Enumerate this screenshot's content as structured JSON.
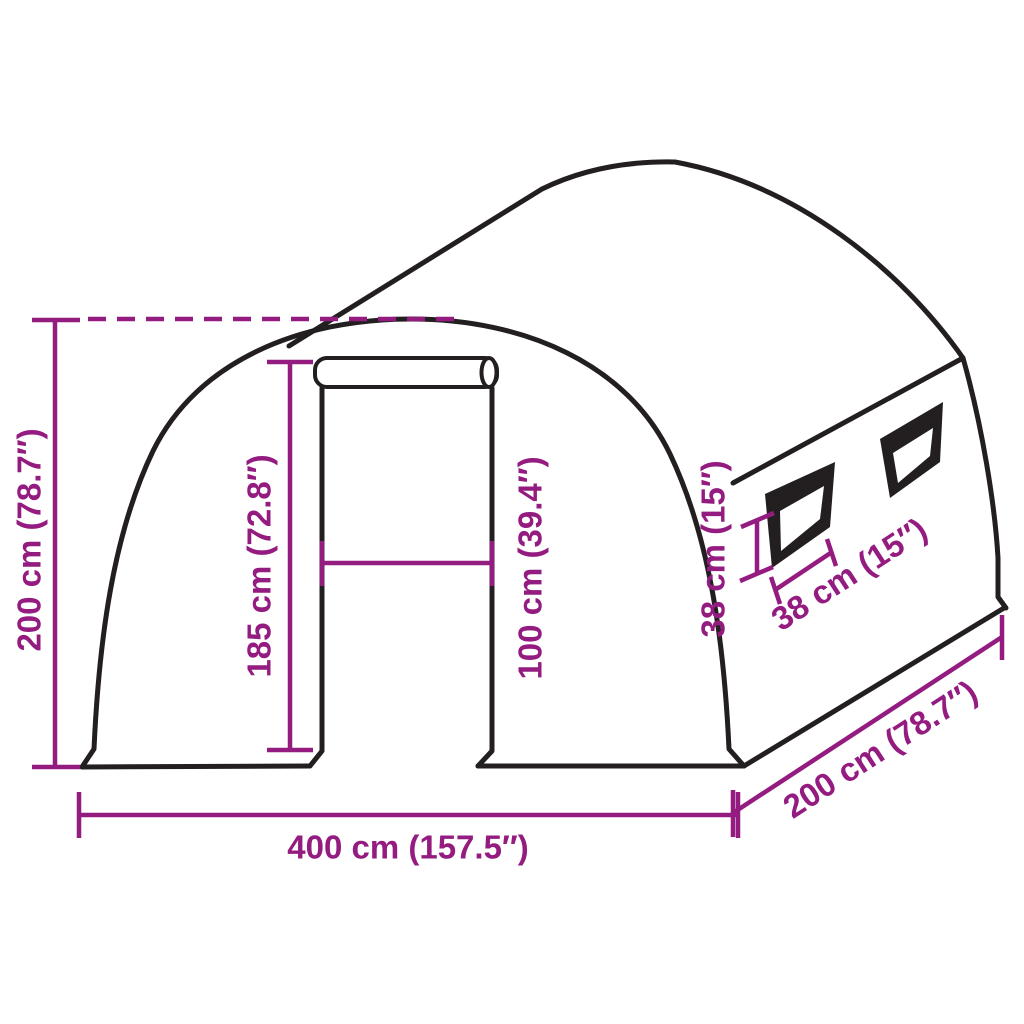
{
  "figure": {
    "type": "product dimension diagram",
    "subject": "Tunnel greenhouse with roll-up front door and two side windows"
  },
  "colors": {
    "dimension": "#941b80",
    "outline": "#231f20",
    "background": "#ffffff"
  },
  "dimensions": {
    "total_height": {
      "label": "200 cm (78.7″)"
    },
    "door_height": {
      "label": "185 cm (72.8″)"
    },
    "door_width": {
      "label": "100 cm (39.4″)"
    },
    "total_width": {
      "label": "400 cm (157.5″)"
    },
    "total_depth": {
      "label": "200 cm (78.7″)"
    },
    "window_height": {
      "label": "38 cm (15″)"
    },
    "window_width": {
      "label": "38 cm (15″)"
    }
  }
}
